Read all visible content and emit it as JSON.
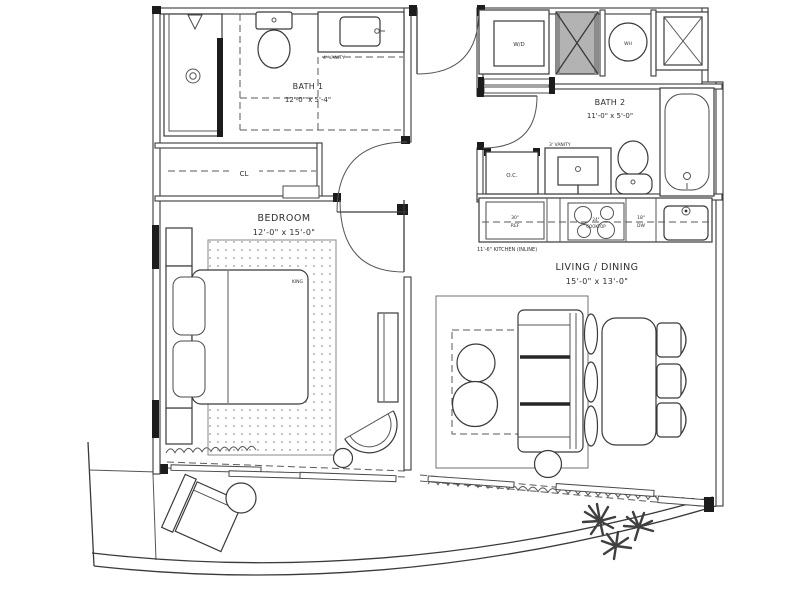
{
  "plan": {
    "title": "one-bedroom floor plan",
    "labels": {
      "bath1_name": "BATH 1",
      "bath1_dims": "12'-0\" x 5'-4\"",
      "bath2_name": "BATH 2",
      "bath2_dims": "11'-0\" x 5'-0\"",
      "bedroom_name": "BEDROOM",
      "bedroom_dims": "12'-0\" x 15'-0\"",
      "living_name": "LIVING / DINING",
      "living_dims": "15'-0\" x 13'-0\"",
      "closet": "CL",
      "owners_closet": "O.C.",
      "washer_dryer": "W/D",
      "water_heater": "WH",
      "bed_size": "KING",
      "vanity_bath1": "4' VANITY",
      "vanity_bath2": "3' VANITY",
      "fridge_size": "30\"",
      "fridge": "REF",
      "cooktop_size": "24\"",
      "cooktop": "COOKTOP",
      "dishwasher_size": "18\"",
      "dishwasher": "DW",
      "kitchen_note": "11'-6\" KITCHEN (INLINE)"
    },
    "colors": {
      "line": "#3a3a3a",
      "shaft_fill": "#b3b3b3",
      "background": "#ffffff"
    }
  }
}
